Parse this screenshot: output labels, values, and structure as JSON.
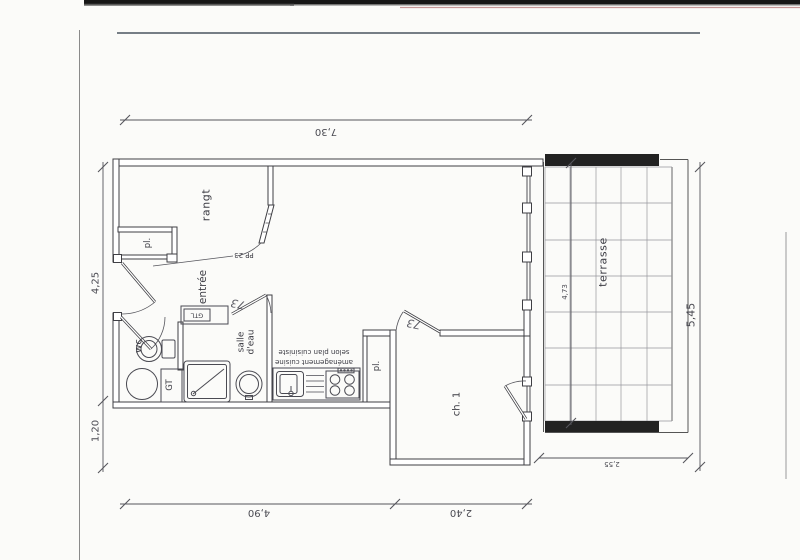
{
  "rooms": {
    "storage": "rangt",
    "closet_upper": "pl.",
    "entry": "entrée",
    "wc": "wc",
    "shower_room_line1": "salle",
    "shower_room_line2": "d'eau",
    "closet_lower": "pl.",
    "bedroom": "ch. 1",
    "terrace": "terrasse"
  },
  "annotations": {
    "technical_duct": "GTL",
    "technical_box": "GT",
    "entry_door_ref": "PP 23",
    "kitchen_note_line1": "aménagement cuisine",
    "kitchen_note_line2": "selon plan cuisiniste",
    "handwritten_door_width_1": "73",
    "handwritten_door_width_2": "73"
  },
  "dimensions": {
    "top_width": "7,30",
    "left_upper": "4,25",
    "left_lower": "1,20",
    "bottom_left": "4,90",
    "bottom_right": "2,40",
    "right_total": "5,45",
    "terrace_height": "4,73",
    "terrace_width": "2,55"
  },
  "colors": {
    "ink": "#3f3f44",
    "paper": "#fbfbf9",
    "scan_bar": "#1a1a1a"
  }
}
